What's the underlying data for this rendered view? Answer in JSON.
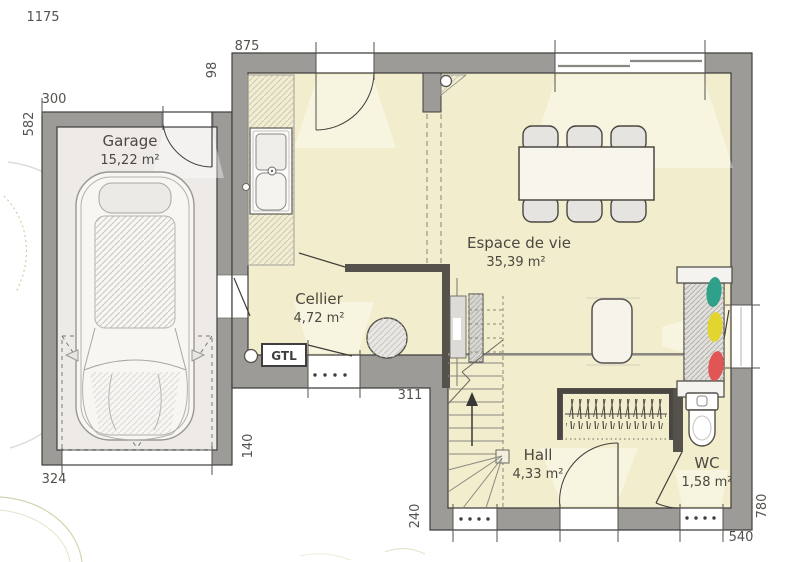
{
  "plan": {
    "rooms": [
      {
        "id": "garage",
        "name": "Garage",
        "area": "15,22 m²"
      },
      {
        "id": "espace_de_vie",
        "name": "Espace de vie",
        "area": "35,39 m²"
      },
      {
        "id": "cellier",
        "name": "Cellier",
        "area": "4,72 m²"
      },
      {
        "id": "hall",
        "name": "Hall",
        "area": "4,33 m²"
      },
      {
        "id": "wc",
        "name": "WC",
        "area": "1,58 m²"
      }
    ],
    "labels": {
      "gtl": "GTL"
    },
    "dimensions": {
      "total_width": "1175",
      "house_top": "875",
      "porch_return": "98",
      "garage_top": "300",
      "garage_left": "582",
      "garage_bottom": "324",
      "garage_right": "140",
      "cellier_bottom": "311",
      "hall_left": "240",
      "bottom_right": "540",
      "right_side": "780"
    },
    "colors": {
      "wall": "#9d9b97",
      "floor_living": "#f2eecd",
      "floor_garage": "#edeae7",
      "partition": "#55514b",
      "cushion_teal": "#2fa08a",
      "cushion_yellow": "#e2d52f",
      "cushion_red": "#e25555"
    },
    "furniture": [
      "car",
      "kitchen-sink",
      "water-heater",
      "gtl-box",
      "staircase",
      "sliding-door",
      "dining-table",
      "dining-chairs",
      "side-table",
      "sofa",
      "coat-closet",
      "toilet"
    ]
  }
}
